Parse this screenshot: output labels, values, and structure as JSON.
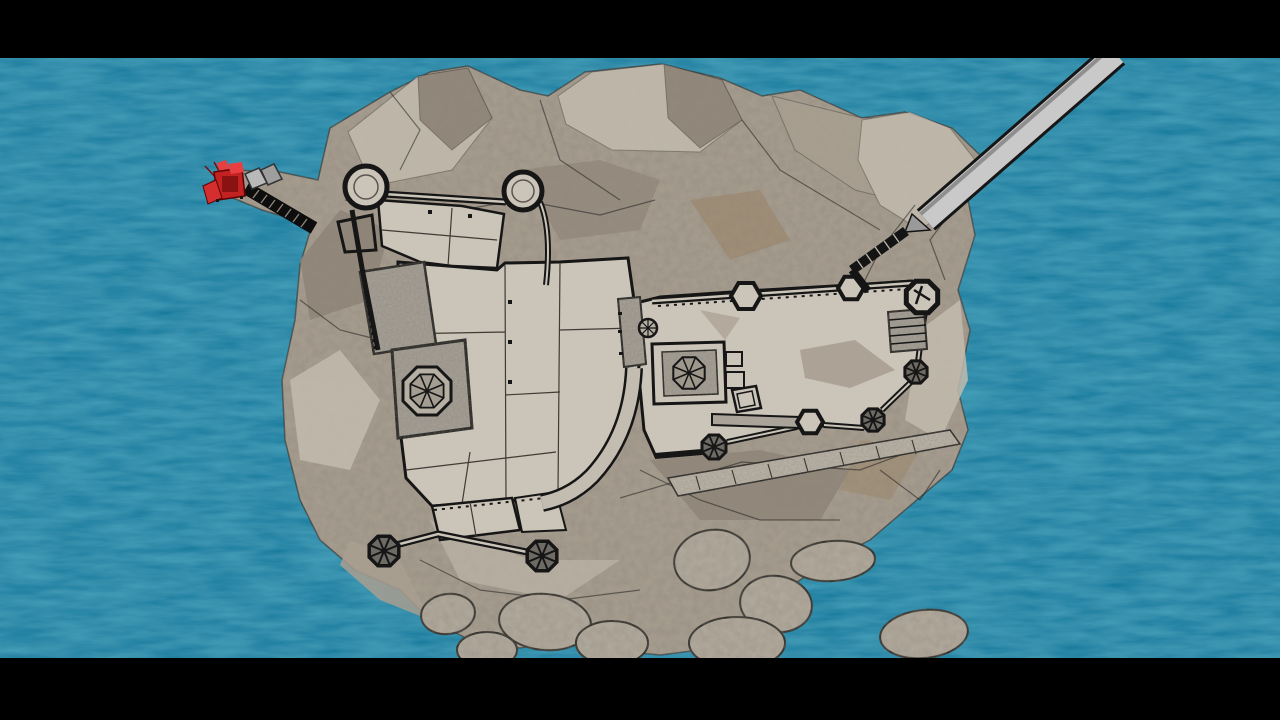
{
  "window": {
    "width_px": 1280,
    "height_px": 720,
    "letterbox_top_px": 58,
    "letterbox_bottom_px": 62
  },
  "scene": {
    "description": "Top-down 3D render of a walled fortress on a rocky island in the sea; a long bridge runs to the northeast shore, a red crane vehicle sits on the western rock spur, and boulders trail off the southern side.",
    "objects": [
      {
        "id": "ocean",
        "label": "sea"
      },
      {
        "id": "island",
        "label": "rocky island"
      },
      {
        "id": "fortress",
        "label": "castle fortress complex"
      },
      {
        "id": "keep",
        "label": "central keep with octagonal spoked roof"
      },
      {
        "id": "west-octagon-tower",
        "label": "large octagonal tower on stone platform"
      },
      {
        "id": "round-towers",
        "label": "two round towers on the north wall"
      },
      {
        "id": "hex-towers",
        "label": "hexagonal bastions on the northeast wall"
      },
      {
        "id": "dark-towers",
        "label": "dark-roofed octagonal turrets with cross ribs"
      },
      {
        "id": "bridge",
        "label": "long gray bridge to the northeast"
      },
      {
        "id": "cliff-stairs",
        "label": "hatched stairway from bridge landing down to the fortress"
      },
      {
        "id": "crane",
        "label": "red crane vehicle with ladder ramp",
        "location": "western rock spur"
      },
      {
        "id": "boulders",
        "label": "boulders in the water",
        "count": 9
      }
    ]
  },
  "colors": {
    "letterbox": "#000000",
    "ocean": "#17789b",
    "ocean_light": "#2d93b5",
    "rock_base": "#a89f91",
    "rock_light": "#c2bbae",
    "rock_dark": "#8e8578",
    "rock_brown": "#9a8569",
    "castle_floor": "#cbc4b8",
    "castle_stone": "#a9a399",
    "wall": "#161616",
    "tower_dark": "#6e6a64",
    "bridge": "#c9c9c9",
    "bridge_edge": "#8f8f8f",
    "crane_red": "#c22222",
    "crane_red_bright": "#e84040",
    "boulder": "#b4ab9e"
  }
}
